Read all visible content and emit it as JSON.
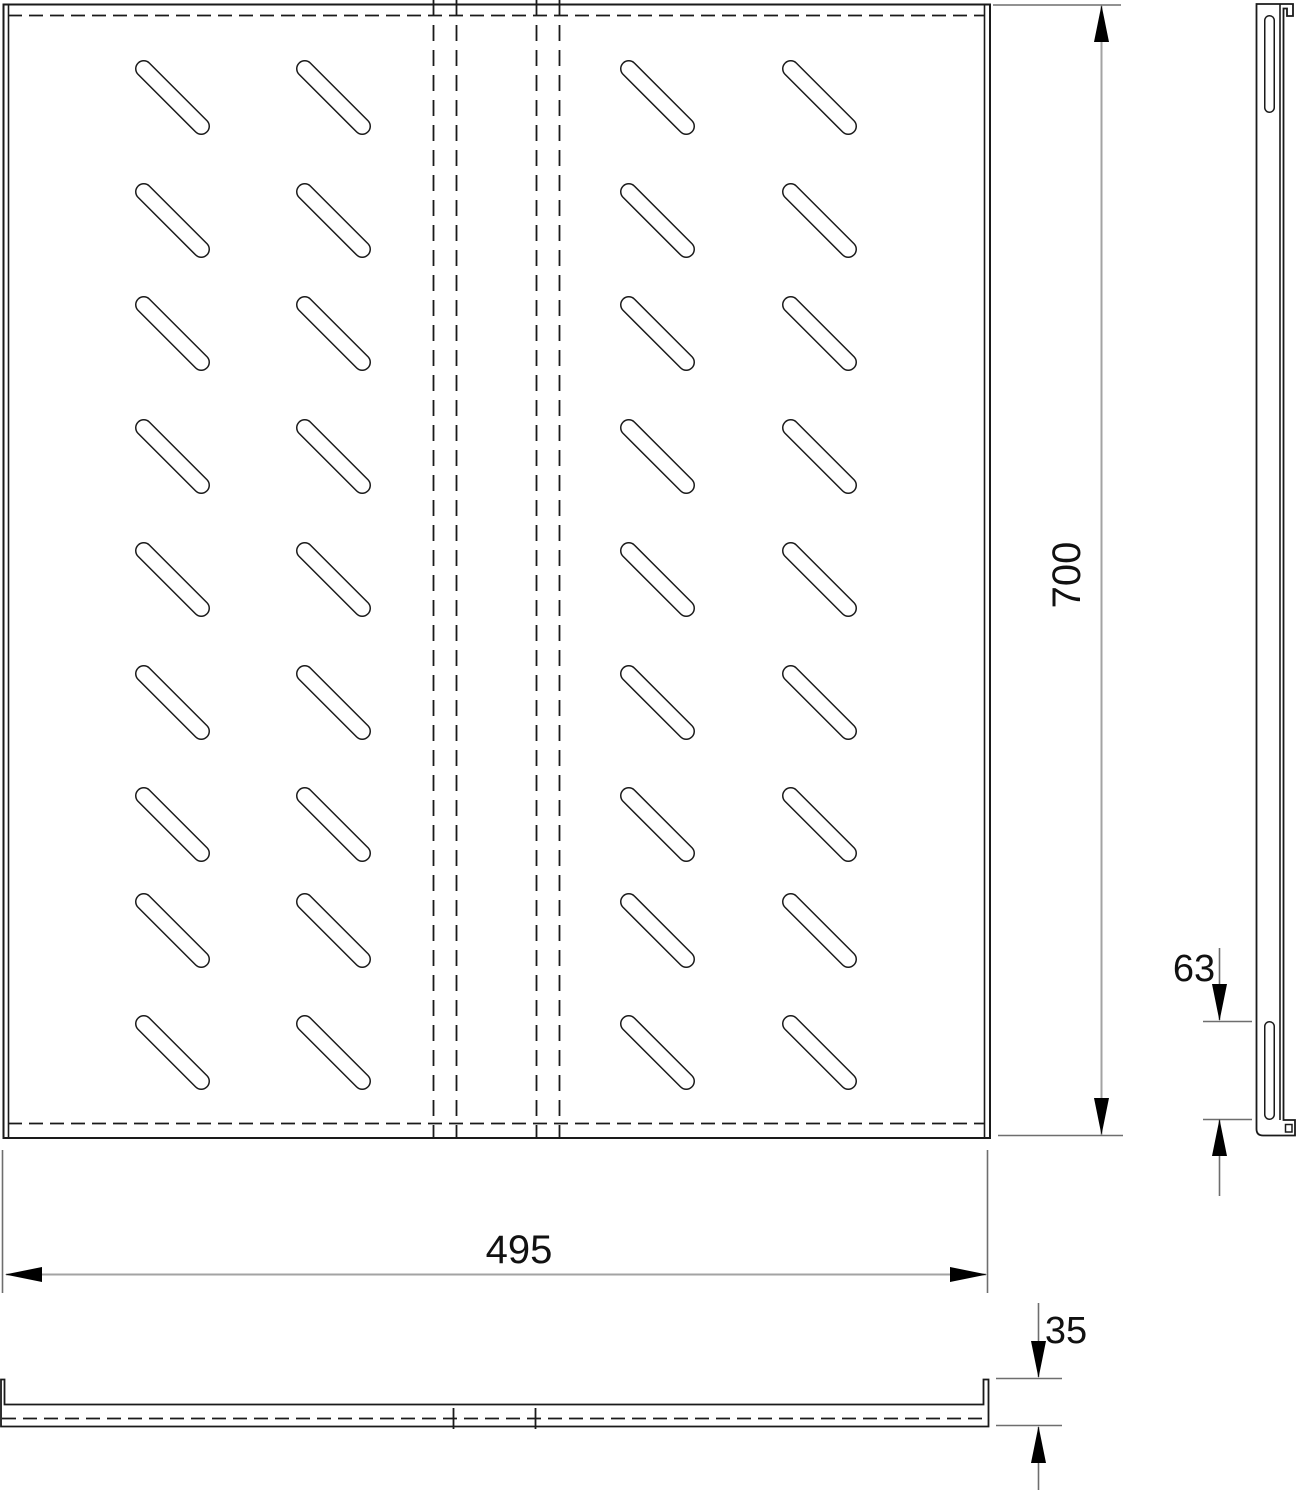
{
  "drawing": {
    "title": "rack-shelf-technical-drawing",
    "colors": {
      "line": "#1a1a1a",
      "dim_line": "#a3a3a3",
      "ext_line": "#6e6e6e",
      "arrow": "#000000",
      "background": "#ffffff"
    },
    "dimensions": {
      "depth": {
        "label": "700"
      },
      "rear_slot": {
        "label": "63"
      },
      "width": {
        "label": "495"
      },
      "front_height": {
        "label": "35"
      }
    },
    "top_view": {
      "slot_grid": {
        "row_tops": [
          60,
          183,
          296,
          419,
          542,
          665,
          787,
          893,
          1015
        ],
        "col_lefts": [
          135,
          296,
          620,
          782
        ],
        "box": 75,
        "outer_stroke": 17.5,
        "inner_stroke": 14.5
      },
      "bend_lines_x": [
        433,
        456,
        536,
        559
      ]
    },
    "side_view": {
      "slots": [
        {
          "cx": 1269.5,
          "y1": 20.5,
          "y2": 107.5
        },
        {
          "cx": 1269.5,
          "y1": 1026.5,
          "y2": 1114.5
        }
      ],
      "outer_stroke": 11,
      "inner_stroke": 8
    },
    "front_view": {
      "bend_ticks_x": [
        453.5,
        535.5
      ]
    }
  }
}
